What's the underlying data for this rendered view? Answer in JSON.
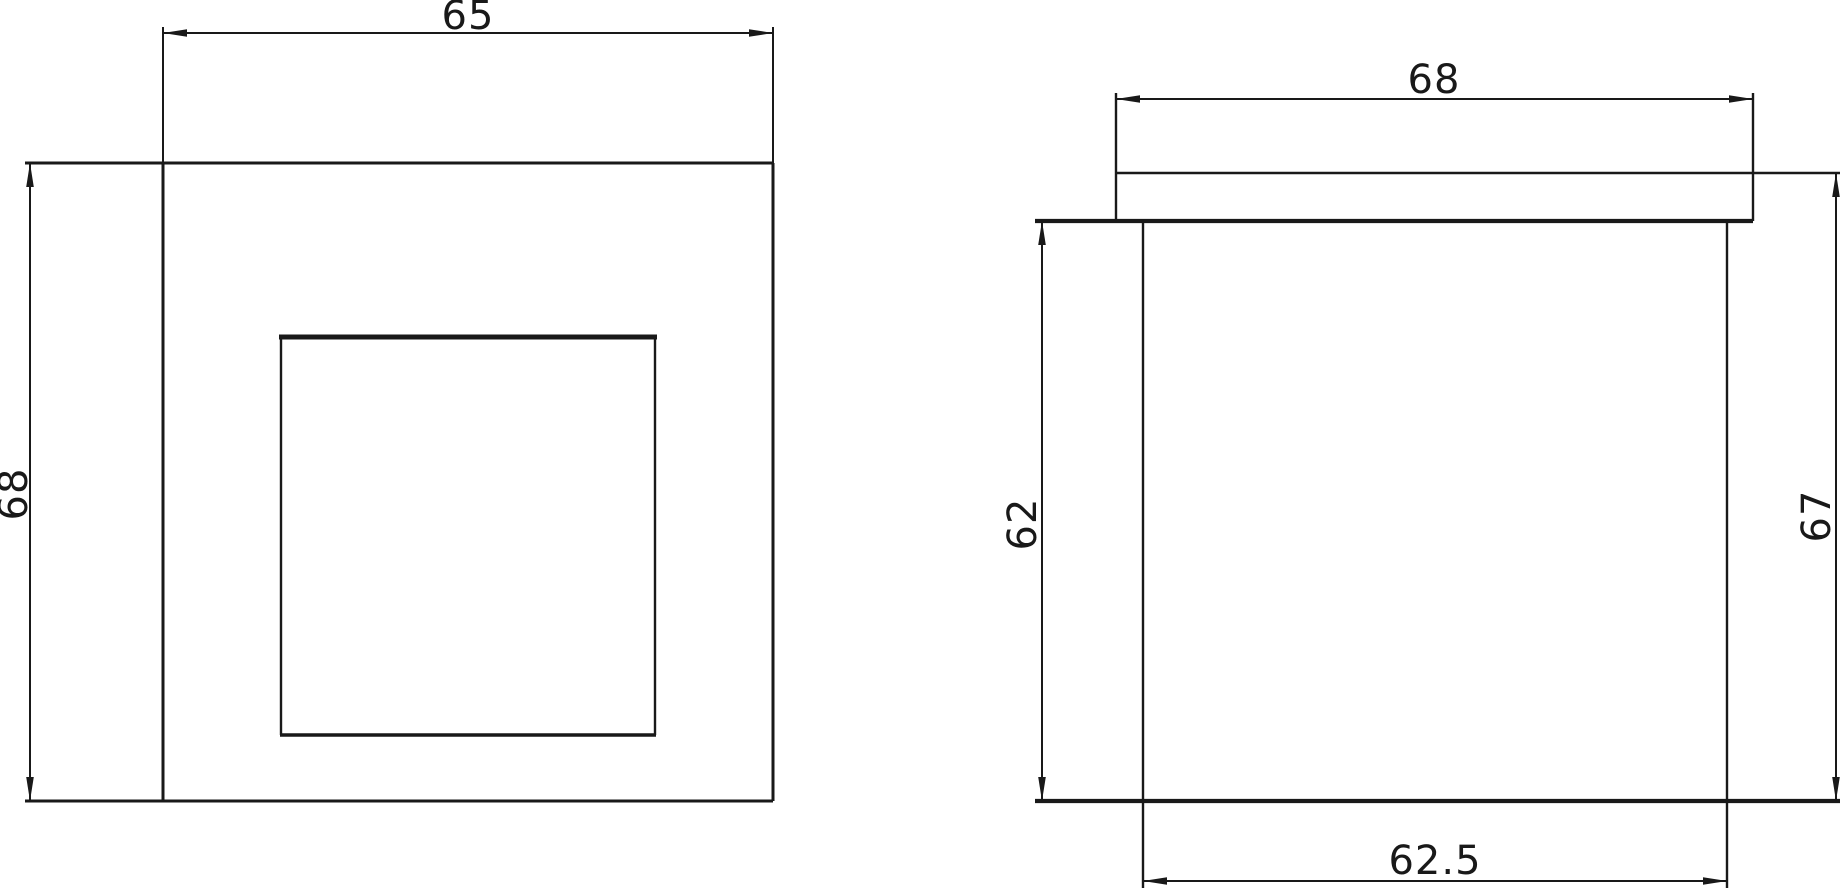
{
  "drawing": {
    "background_color": "#ffffff",
    "line_color": "#191919",
    "views": {
      "front_view": {
        "name": "front view",
        "dimensions": {
          "width_label": "65",
          "height_label": "68"
        }
      },
      "side_view": {
        "name": "side view",
        "dimensions": {
          "flange_width_label": "68",
          "body_height_label": "62",
          "overall_height_label": "67",
          "body_width_label": "62.5"
        }
      }
    }
  }
}
